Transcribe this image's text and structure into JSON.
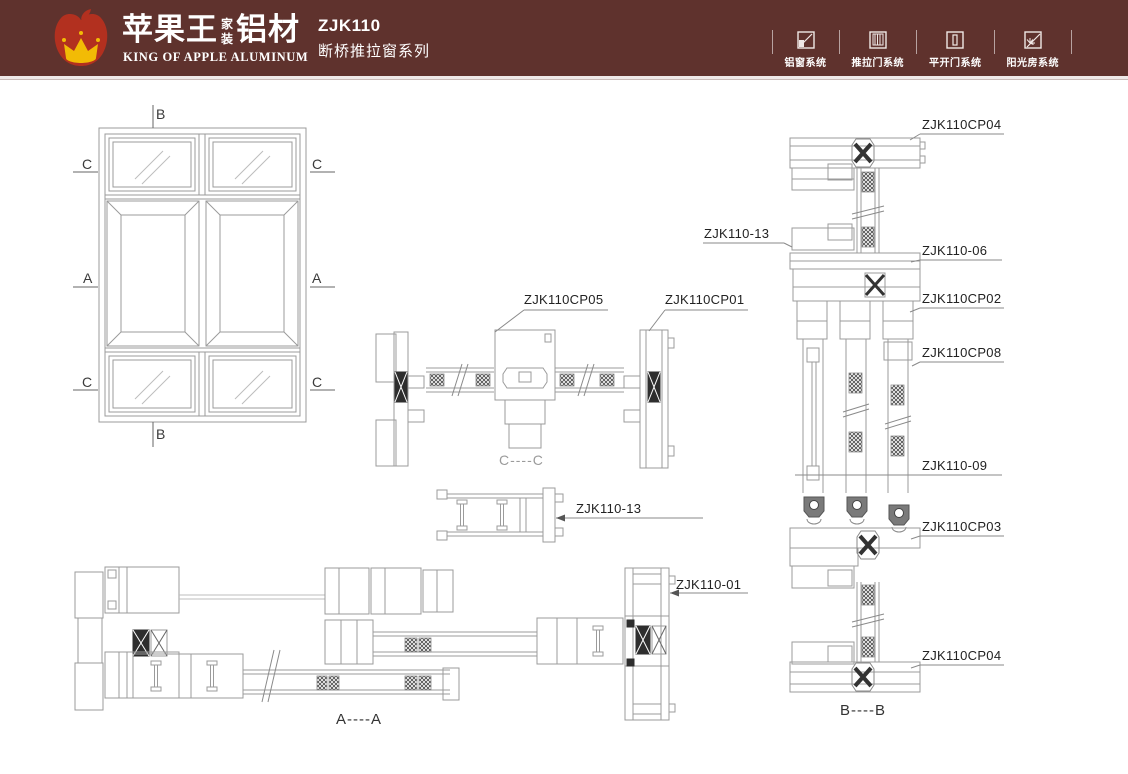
{
  "header": {
    "brand": {
      "cn_main": "苹果王",
      "cn_stack_top": "家",
      "cn_stack_bottom": "装",
      "cn_suffix": "铝材",
      "en": "KING OF APPLE ALUMINUM"
    },
    "product_code": "ZJK110",
    "product_series": "断桥推拉窗系列",
    "nav_items": [
      {
        "label": "铝窗系统",
        "icon": "window-system-icon"
      },
      {
        "label": "推拉门系统",
        "icon": "sliding-door-system-icon"
      },
      {
        "label": "平开门系统",
        "icon": "casement-door-system-icon"
      },
      {
        "label": "阳光房系统",
        "icon": "sunroom-system-icon"
      }
    ]
  },
  "colors": {
    "header_bg": "#5f322d",
    "apple_red": "#b2301f",
    "crown_gold": "#f2bb05",
    "cad_line": "#9b9b9b",
    "hatch_dark": "#2e2e2e",
    "label_ink": "#222222"
  },
  "elevation": {
    "markers": {
      "b": "B",
      "a": "A",
      "c": "C"
    }
  },
  "sections": {
    "cc": {
      "caption": "C----C",
      "label_cp05": "ZJK110CP05",
      "label_cp01": "ZJK110CP01"
    },
    "mid_profile": {
      "label": "ZJK110-13"
    },
    "aa": {
      "caption": "A----A",
      "label_01": "ZJK110-01"
    },
    "bb": {
      "caption": "B----B",
      "label_cp04_top": "ZJK110CP04",
      "label_13": "ZJK110-13",
      "label_06": "ZJK110-06",
      "label_cp02": "ZJK110CP02",
      "label_cp08": "ZJK110CP08",
      "label_09": "ZJK110-09",
      "label_cp03": "ZJK110CP03",
      "label_cp04_bottom": "ZJK110CP04"
    }
  }
}
